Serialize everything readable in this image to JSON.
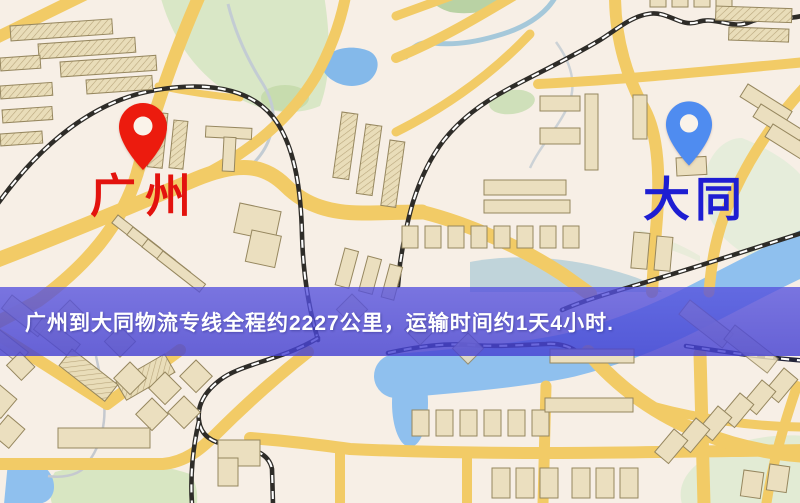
{
  "banner": {
    "text": "广州到大同物流专线全程约2227公里，运输时间约1天4小时.",
    "route": {
      "origin": "广州",
      "destination": "大同",
      "distance_text": "约2227公里",
      "duration_text": "约1天4小时"
    },
    "background_color": "#4f4bd7",
    "text_color": "#ffffff"
  },
  "map": {
    "origin_marker": {
      "label": "广州",
      "pin_color": "#ec1b0e",
      "label_color": "#e3130e",
      "icon": "red-map-pin-icon"
    },
    "destination_marker": {
      "label": "大同",
      "pin_color": "#4f8cf0",
      "label_color": "#1e1ed2",
      "icon": "blue-map-pin-icon"
    },
    "colors": {
      "background": "#f7efe6",
      "road": "#f2cb66",
      "building": "#ebdfbf",
      "park": "#d9e7c6",
      "water": "#86b9e8",
      "railway": "#2e2c28"
    }
  }
}
